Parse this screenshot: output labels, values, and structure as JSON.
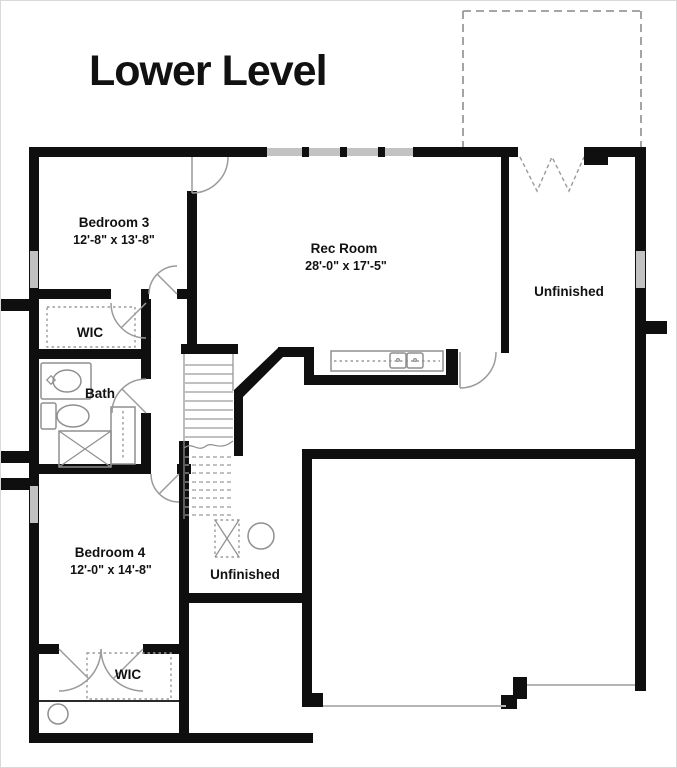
{
  "title": "Lower Level",
  "rooms": {
    "bedroom3": {
      "name": "Bedroom 3",
      "dims": "12'-8\" x 13'-8\""
    },
    "rec_room": {
      "name": "Rec Room",
      "dims": "28'-0\" x 17'-5\""
    },
    "unfinished_right": {
      "name": "Unfinished"
    },
    "wic_upper": {
      "name": "WIC"
    },
    "bath": {
      "name": "Bath"
    },
    "bedroom4": {
      "name": "Bedroom 4",
      "dims": "12'-0\" x 14'-8\""
    },
    "unfinished_center": {
      "name": "Unfinished"
    },
    "wic_lower": {
      "name": "WIC"
    }
  },
  "colors": {
    "wall": "#0f0f0f",
    "window": "#c2c2c2",
    "fixture": "#8f8f8f",
    "dash": "#9a9a9a",
    "text": "#111111",
    "bg": "#ffffff"
  }
}
